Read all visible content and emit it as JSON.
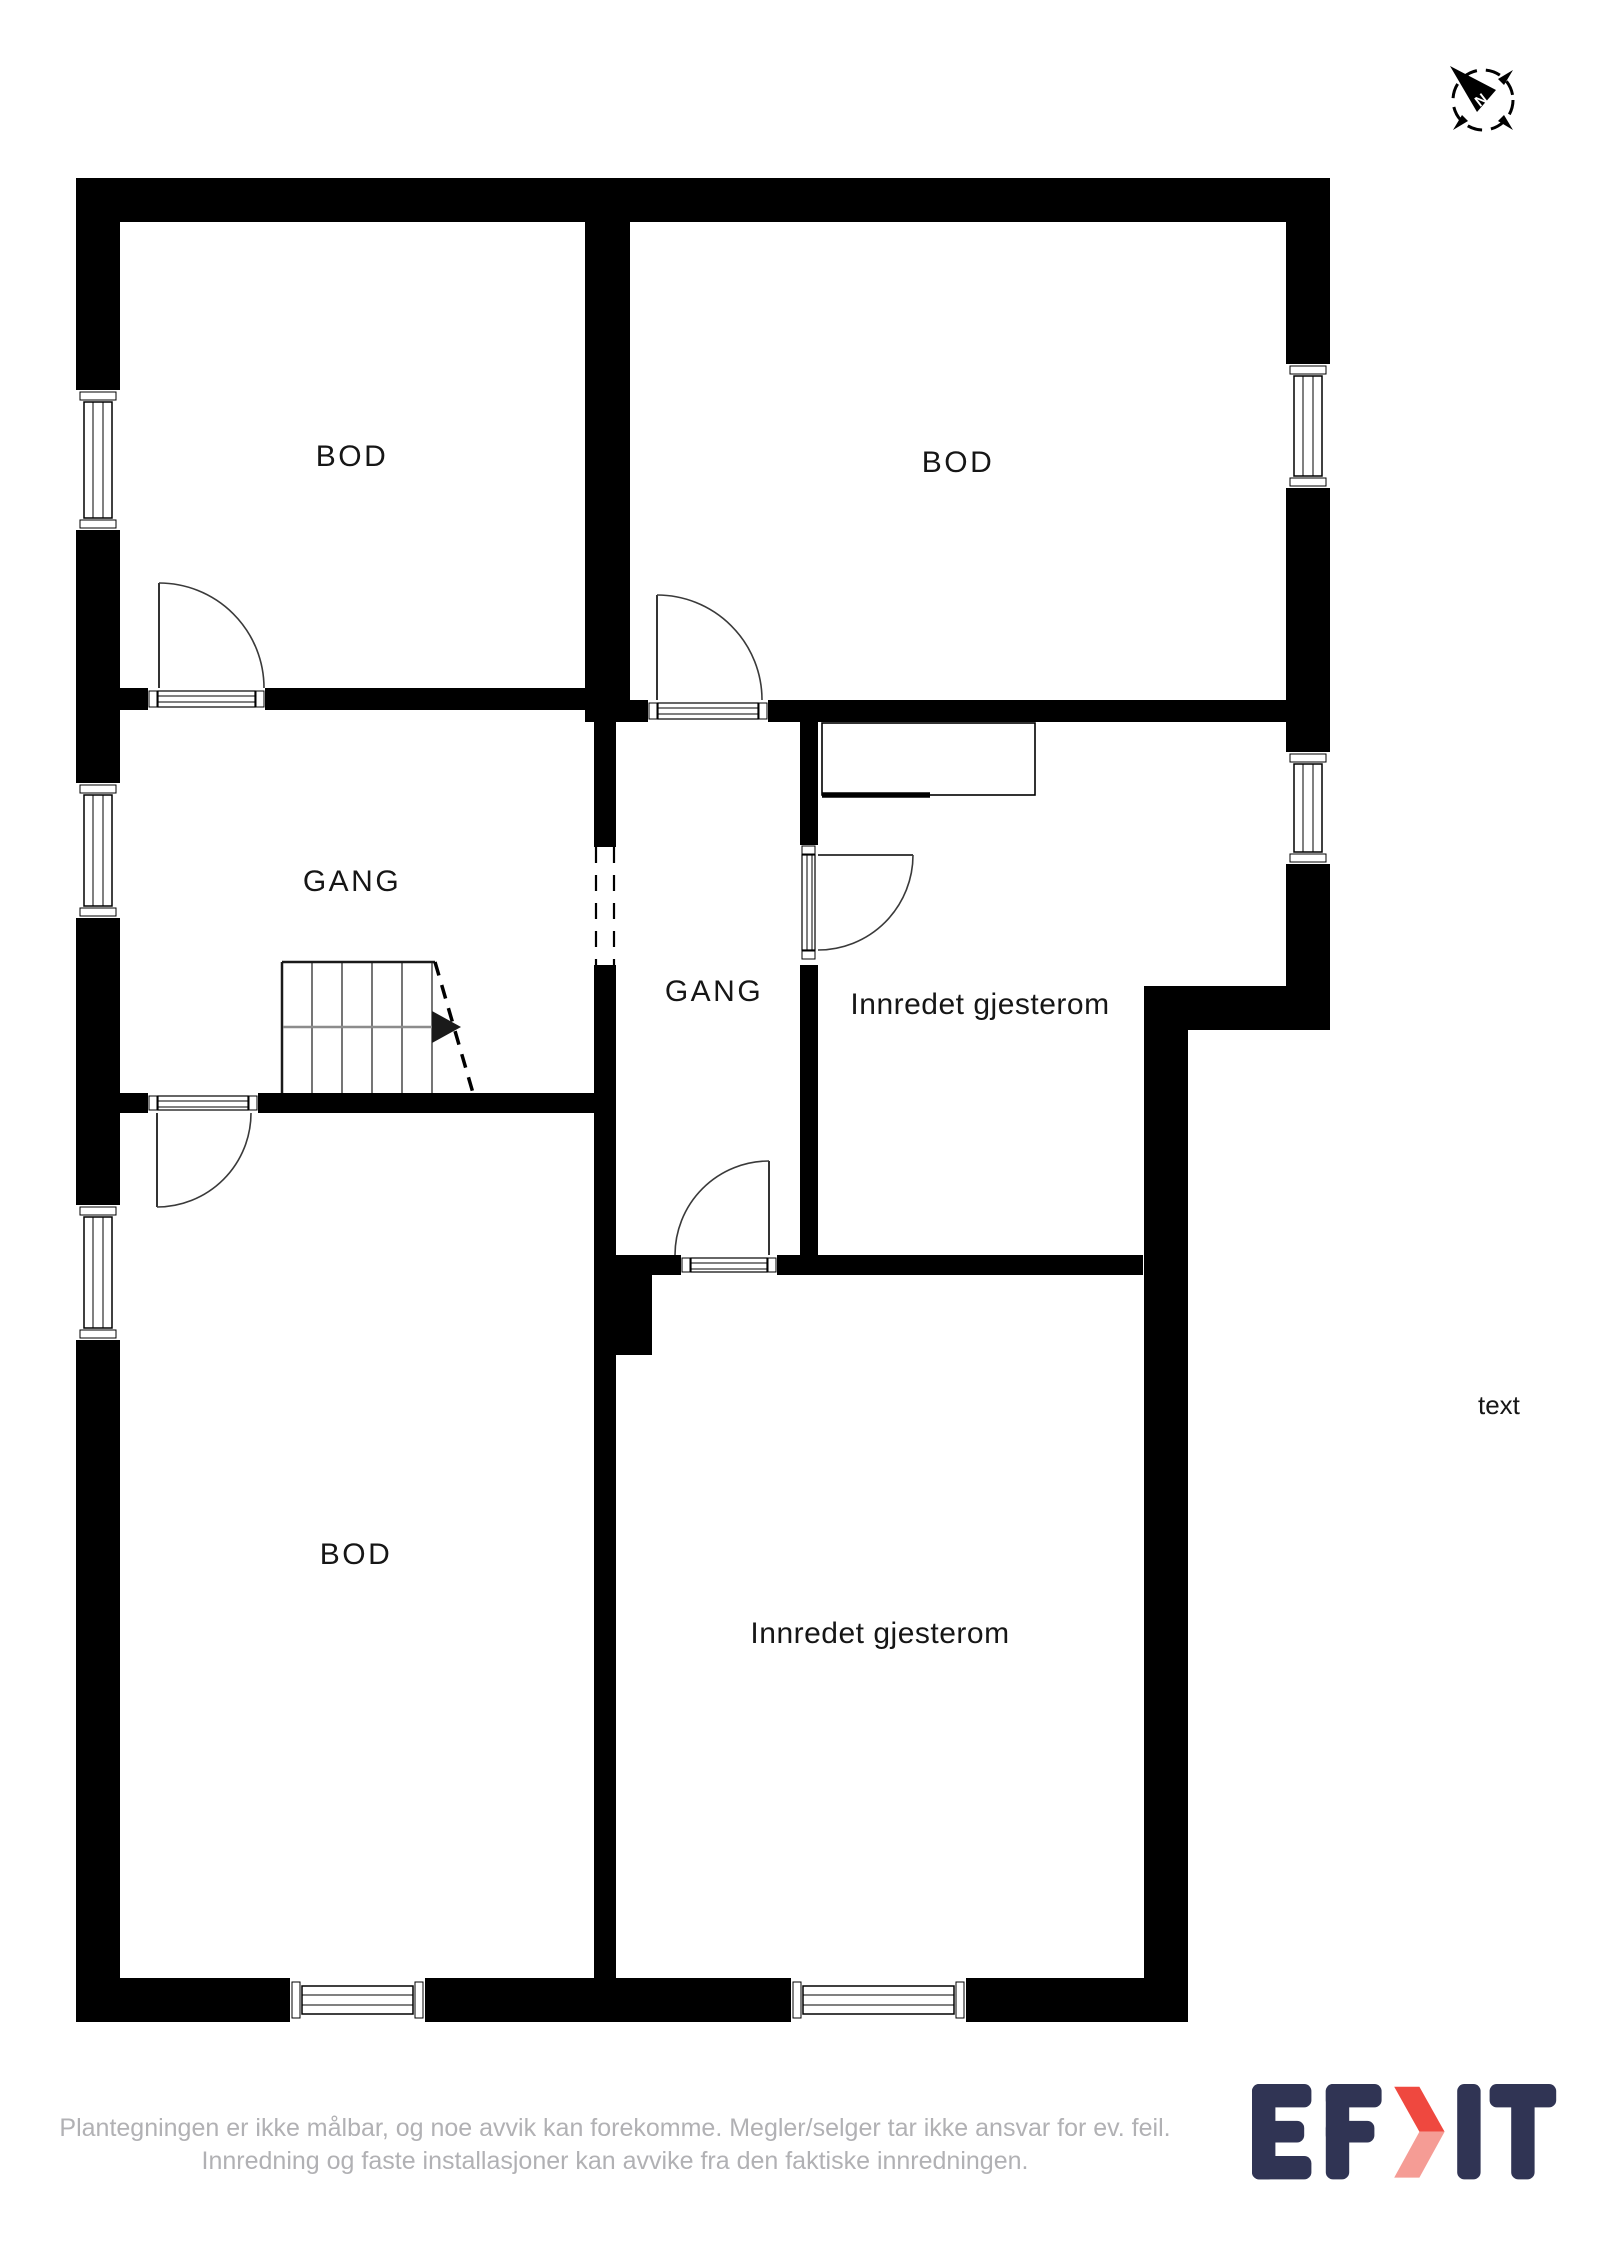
{
  "colors": {
    "wall": "#000000",
    "room_label": "#161616",
    "disclaimer_text": "#b1b1b4",
    "logo_navy": "#303454",
    "logo_red": "#ef483f",
    "logo_red_light": "#f59c95",
    "stair_direction_line": "#8c8c8c"
  },
  "compass": {
    "icon": "compass-icon",
    "north_label": "N"
  },
  "floor_plan": {
    "rooms": [
      {
        "id": "bod-top-left",
        "label": "BOD"
      },
      {
        "id": "bod-top-right",
        "label": "BOD"
      },
      {
        "id": "gang-left",
        "label": "GANG"
      },
      {
        "id": "gang-center",
        "label": "GANG"
      },
      {
        "id": "gjesterom-upper",
        "label": "Innredet gjesterom"
      },
      {
        "id": "bod-bottom",
        "label": "BOD"
      },
      {
        "id": "gjesterom-lower",
        "label": "Innredet gjesterom"
      }
    ],
    "annotation": "text"
  },
  "footer": {
    "disclaimer_line1": "Plantegningen er ikke målbar, og noe avvik kan forekomme. Megler/selger tar ikke ansvar for ev. feil.",
    "disclaimer_line2": "Innredning og faste installasjoner kan avvike fra den faktiske innredningen."
  },
  "logo": {
    "name": "EFKT",
    "chevron_icon": "chevron-right-icon"
  }
}
